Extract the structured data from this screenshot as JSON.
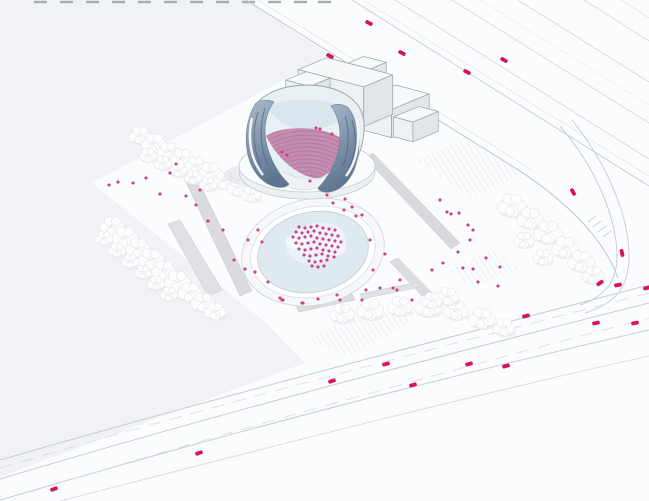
{
  "scene": {
    "width": 649,
    "height": 501
  },
  "palette": {
    "bg": "#fbfcfd",
    "field": "#f1f2f5",
    "accent_pink": "#dd3d86",
    "accent_pink_dark": "#b21e63",
    "car": "#d6135e",
    "road_line": "#c9cdd3",
    "road_line_faint": "#dfe2e6",
    "dash_line": "#d8dbdf",
    "hatch_line": "#e3e5e9",
    "glass_light": "#e9f0f4",
    "glass_mid": "#d9e6ee",
    "seating_pink": "#c58cb1",
    "seat_stripe": "#aa6f9f",
    "wing_top": "#a9bac9",
    "wing_bottom": "#5e7590",
    "wing_streak": "#51688a",
    "box_top": "#f7f8fa",
    "box_front": "#eef0f3",
    "box_side": "#e2e5ea",
    "box_stroke": "#9aa1ab",
    "tree_fill": "#fdfdfe",
    "tree_stroke": "#dcdee4",
    "tree_shadow": "#e9eaee",
    "ramp_fill": "#dadbdf",
    "plaza_floor": "#dfe9f0"
  },
  "ground": {
    "field_polygon": [
      [
        0,
        0
      ],
      [
        246,
        0
      ],
      [
        330,
        55
      ],
      [
        92,
        183
      ],
      [
        265,
        322
      ],
      [
        305,
        363
      ],
      [
        150,
        421
      ],
      [
        0,
        477
      ]
    ],
    "hatches": [
      [
        [
          415,
          160
        ],
        [
          463,
          140
        ],
        [
          524,
          172
        ],
        [
          474,
          199
        ]
      ],
      [
        [
          306,
          341
        ],
        [
          362,
          309
        ],
        [
          420,
          318
        ],
        [
          350,
          356
        ]
      ],
      [
        [
          448,
          268
        ],
        [
          492,
          250
        ],
        [
          520,
          268
        ],
        [
          474,
          288
        ]
      ]
    ],
    "top_dashes": {
      "y": 2,
      "len": 13,
      "xs": [
        34,
        60,
        86,
        112,
        138,
        164,
        190,
        216,
        242,
        268,
        294,
        318
      ]
    }
  },
  "roads": {
    "highway": [
      {
        "d": "M 246,0 L 520,171 C 574,207 605,242 618,278",
        "w": 1.1,
        "c": "#c6cad0"
      },
      {
        "d": "M 258,0 L 532,170",
        "w": 0.7,
        "c": "#dfe2e6"
      },
      {
        "d": "M 352,0 L 649,186",
        "w": 1.0,
        "c": "#ccd0d6"
      },
      {
        "d": "M 363,0 L 649,176",
        "w": 0.6,
        "c": "#e0e3e7"
      },
      {
        "d": "M 395,0 L 649,159",
        "w": 0.8,
        "c": "#d3d6db"
      },
      {
        "d": "M 452,0 L 649,123",
        "w": 0.8,
        "c": "#d3d6db"
      },
      {
        "d": "M 480,0 L 649,105",
        "w": 0.5,
        "c": "#e2e4e8"
      },
      {
        "d": "M 518,0 L 649,82",
        "w": 0.8,
        "c": "#d3d6db"
      },
      {
        "d": "M 584,0 L 649,41",
        "w": 0.8,
        "c": "#d3d6db"
      },
      {
        "d": "M 621,0 L 649,18",
        "w": 0.6,
        "c": "#d8dbdf"
      }
    ],
    "right_road": [
      {
        "d": "M 560,126 C 596,168 615,215 617,252 C 618,281 606,296 580,305",
        "w": 1.0,
        "c": "#c9cdd3"
      },
      {
        "d": "M 572,120 C 608,165 628,215 629,253 C 630,287 615,304 585,313",
        "w": 1.0,
        "c": "#ccd0d6"
      }
    ],
    "boulevard": [
      {
        "d": "M 0,460 C 200,402 420,345 649,285",
        "w": 1.0,
        "c": "#c7cbd1"
      },
      {
        "d": "M 0,479 C 200,419 420,361 649,303",
        "w": 1.0,
        "c": "#c9cdd3"
      },
      {
        "d": "M 0,500 C 210,438 430,380 649,330",
        "w": 1.0,
        "c": "#c9cdd3"
      },
      {
        "d": "M 60,501 C 250,452 460,398 649,356",
        "w": 0.8,
        "c": "#d3d6db"
      }
    ],
    "lane_dashes": [
      {
        "d": "M 0,468 C 200,409 420,352 649,293",
        "w": 0.8,
        "c": "#d8dbdf",
        "dash": "13,9"
      },
      {
        "d": "M 30,492 C 230,431 440,373 649,318",
        "w": 0.8,
        "c": "#d8dbdf",
        "dash": "13,9"
      }
    ],
    "crosswalk_ticks": [
      [
        588,
        222,
        596,
        216
      ],
      [
        593,
        227,
        601,
        221
      ],
      [
        598,
        232,
        606,
        226
      ],
      [
        603,
        237,
        611,
        231
      ]
    ]
  },
  "ramps": [
    {
      "pts": [
        [
          185,
          180
        ],
        [
          196,
          176
        ],
        [
          252,
          291
        ],
        [
          240,
          296
        ]
      ],
      "fill": "#dadbdf"
    },
    {
      "pts": [
        [
          168,
          224
        ],
        [
          180,
          220
        ],
        [
          222,
          290
        ],
        [
          208,
          296
        ]
      ],
      "fill": "#e0e1e4"
    },
    {
      "pts": [
        [
          365,
          158
        ],
        [
          373,
          153
        ],
        [
          460,
          243
        ],
        [
          451,
          249
        ]
      ],
      "fill": "#d8d9dd"
    },
    {
      "pts": [
        [
          390,
          262
        ],
        [
          398,
          258
        ],
        [
          432,
          293
        ],
        [
          424,
          298
        ]
      ],
      "fill": "#dcdde1"
    },
    {
      "pts": [
        [
          296,
          306
        ],
        [
          352,
          294
        ],
        [
          355,
          300
        ],
        [
          299,
          312
        ]
      ],
      "fill": "#dcdde1"
    },
    {
      "pts": [
        [
          360,
          294
        ],
        [
          418,
          282
        ],
        [
          420,
          287
        ],
        [
          362,
          299
        ]
      ],
      "fill": "#e0e1e5"
    }
  ],
  "plaza": {
    "center": [
      313,
      252
    ],
    "rotate": -12,
    "rings": [
      {
        "rx": 72,
        "ry": 53,
        "fill": "#f5f7f9",
        "stroke": "#d0d4da"
      },
      {
        "rx": 63,
        "ry": 45,
        "fill": "#ffffff",
        "stroke": "#dadde2"
      },
      {
        "rx": 56,
        "ry": 40,
        "fill": "#dfe9f0",
        "stroke": "#c2ced7"
      }
    ],
    "floor_blobs": [
      {
        "cx": 318,
        "cy": 244,
        "rx": 30,
        "ry": 20,
        "fill": "#ecf3f7"
      },
      {
        "cx": 300,
        "cy": 238,
        "rx": 12,
        "ry": 8,
        "fill": "#f4f8fa"
      },
      {
        "cx": 333,
        "cy": 252,
        "rx": 14,
        "ry": 9,
        "fill": "#f1f6f9"
      }
    ],
    "ramp_d": "M 252,262 C 258,286 280,300 312,303 C 290,307 266,301 254,288 C 246,277 247,268 252,262 Z"
  },
  "fly_tower": {
    "origin": [
      330,
      96
    ],
    "e1": [
      16,
      4.2
    ],
    "e2": [
      -14.5,
      6
    ],
    "unit_h": 12,
    "boxes": [
      {
        "name": "back-arm",
        "u0": 1.3,
        "v0": -0.9,
        "u1": 2.7,
        "v1": 0.2,
        "h": 3.3
      },
      {
        "name": "right-hall",
        "u0": 4.1,
        "v0": 0.0,
        "u1": 6.2,
        "v1": 2.6,
        "h": 2.35
      },
      {
        "name": "far-annex",
        "u0": 6.2,
        "v0": 0.7,
        "u1": 7.4,
        "v1": 2.45,
        "h": 1.65
      },
      {
        "name": "center-bar",
        "u0": 0.0,
        "v0": 0.2,
        "u1": 4.1,
        "v1": 2.2,
        "h": 3.3
      },
      {
        "name": "left-wing",
        "u0": 0.5,
        "v0": 2.2,
        "u1": 2.0,
        "v1": 3.6,
        "h": 3.3
      }
    ]
  },
  "concert_hall": {
    "shadow": {
      "cx": 268,
      "cy": 175,
      "rx": 44,
      "ry": 13
    },
    "plinth": [
      {
        "cx": 307,
        "cy": 172,
        "rx": 68,
        "ry": 27,
        "fill": "#edf0f3",
        "stroke": "#c6cad0"
      },
      {
        "cx": 307,
        "cy": 166,
        "rx": 68,
        "ry": 26,
        "fill": "#fafbfc",
        "stroke": "#c6cad0"
      }
    ],
    "bowl_d": "M 250,120 C 252,100 272,86 306,85 C 340,85 362,100 364,122 C 365,140 360,158 348,172 C 330,190 288,192 268,176 C 254,164 248,142 250,120 Z",
    "glass_top_d": "M 268,108 C 282,96 334,96 350,112 C 338,124 324,130 306,131 C 288,129 276,120 268,108 Z",
    "seating_d": "M 266,136 C 284,124 330,126 346,142 C 344,158 334,172 318,179 C 298,176 278,160 266,136 Z",
    "stage_d": "M 268,162 C 286,180 324,184 340,170 C 336,182 320,190 300,190 C 284,188 272,176 268,162 Z",
    "left_wing_d": "M 256,103 C 246,118 243,142 250,162 C 255,175 264,184 276,187 C 282,188 287,187 289,184 C 276,172 266,152 265,132 C 265,120 268,110 274,102 C 268,99 260,100 256,103 Z",
    "right_wing_d": "M 350,110 C 360,126 362,150 354,170 C 349,182 340,190 330,192 C 324,193 319,191 318,188 C 330,176 340,156 340,136 C 340,124 337,114 331,106 C 338,103 346,104 350,110 Z",
    "streaks": [
      "M 258,112 C 252,130 253,150 261,166",
      "M 265,108 C 259,128 260,148 268,165",
      "M 352,120 C 357,136 356,154 349,168",
      "M 345,116 C 350,132 349,152 342,167"
    ],
    "ribbons": [
      "M 252,118 C 247,140 251,160 263,175",
      "M 356,118 C 361,140 357,162 346,176"
    ],
    "stripes": {
      "cx": 306,
      "cy": 215,
      "r0": 36,
      "r1": 92,
      "step": 4
    }
  },
  "trees": [
    [
      140,
      135,
      10
    ],
    [
      154,
      143,
      11
    ],
    [
      168,
      151,
      10
    ],
    [
      182,
      158,
      11
    ],
    [
      196,
      165,
      10
    ],
    [
      210,
      172,
      11
    ],
    [
      224,
      180,
      10
    ],
    [
      238,
      187,
      10
    ],
    [
      251,
      194,
      9
    ],
    [
      148,
      155,
      8
    ],
    [
      163,
      163,
      8
    ],
    [
      178,
      170,
      8
    ],
    [
      193,
      177,
      8
    ],
    [
      208,
      184,
      8
    ],
    [
      112,
      226,
      11
    ],
    [
      125,
      237,
      12
    ],
    [
      138,
      248,
      11
    ],
    [
      151,
      259,
      12
    ],
    [
      164,
      270,
      11
    ],
    [
      177,
      281,
      12
    ],
    [
      190,
      292,
      11
    ],
    [
      203,
      302,
      11
    ],
    [
      215,
      311,
      10
    ],
    [
      104,
      238,
      8
    ],
    [
      117,
      250,
      8
    ],
    [
      130,
      261,
      8
    ],
    [
      143,
      272,
      8
    ],
    [
      156,
      283,
      8
    ],
    [
      169,
      294,
      8
    ],
    [
      342,
      313,
      11
    ],
    [
      370,
      309,
      12
    ],
    [
      400,
      306,
      11
    ],
    [
      428,
      306,
      12
    ],
    [
      456,
      310,
      11
    ],
    [
      482,
      318,
      12
    ],
    [
      504,
      327,
      10
    ],
    [
      512,
      205,
      13
    ],
    [
      530,
      218,
      12
    ],
    [
      548,
      232,
      13
    ],
    [
      565,
      247,
      12
    ],
    [
      581,
      261,
      12
    ],
    [
      593,
      275,
      10
    ],
    [
      524,
      240,
      9
    ],
    [
      543,
      257,
      9
    ],
    [
      448,
      296,
      10
    ],
    [
      432,
      300,
      9
    ]
  ],
  "cars": [
    [
      369,
      23,
      27
    ],
    [
      330,
      56,
      27
    ],
    [
      402,
      53,
      27
    ],
    [
      467,
      72,
      27
    ],
    [
      504,
      60,
      27
    ],
    [
      573,
      192,
      62
    ],
    [
      622,
      253,
      78
    ],
    [
      600,
      283,
      -35
    ],
    [
      647,
      288,
      -12
    ],
    [
      618,
      285,
      -12
    ],
    [
      635,
      323,
      -10
    ],
    [
      596,
      323,
      -12
    ],
    [
      526,
      316,
      -15
    ],
    [
      506,
      366,
      -14
    ],
    [
      469,
      364,
      -15
    ],
    [
      413,
      385,
      -16
    ],
    [
      386,
      364,
      -16
    ],
    [
      332,
      381,
      -18
    ],
    [
      199,
      453,
      -19
    ],
    [
      54,
      489,
      -20
    ]
  ],
  "people": {
    "r": 1.4,
    "groups": {
      "west_lawn": [
        [
          109,
          185
        ],
        [
          118,
          182
        ],
        [
          133,
          183
        ],
        [
          146,
          178
        ],
        [
          160,
          194
        ],
        [
          170,
          173
        ],
        [
          176,
          164
        ],
        [
          200,
          190
        ],
        [
          208,
          221
        ],
        [
          223,
          230
        ],
        [
          234,
          260
        ],
        [
          245,
          269
        ],
        [
          196,
          205
        ],
        [
          186,
          196
        ]
      ],
      "north_terrace": [
        [
          327,
          195
        ],
        [
          333,
          203
        ],
        [
          345,
          199
        ],
        [
          352,
          207
        ],
        [
          362,
          215
        ]
      ],
      "east_walk": [
        [
          440,
          200
        ],
        [
          447,
          212
        ],
        [
          451,
          214
        ],
        [
          459,
          213
        ],
        [
          468,
          225
        ],
        [
          473,
          230
        ],
        [
          470,
          240
        ],
        [
          458,
          252
        ],
        [
          443,
          263
        ],
        [
          432,
          270
        ],
        [
          463,
          268
        ],
        [
          473,
          269
        ],
        [
          500,
          267
        ],
        [
          498,
          286
        ],
        [
          486,
          258
        ],
        [
          478,
          282
        ]
      ],
      "plaza_ring": [
        [
          258,
          230
        ],
        [
          248,
          240
        ],
        [
          262,
          242
        ],
        [
          255,
          272
        ],
        [
          268,
          282
        ],
        [
          283,
          300
        ],
        [
          302,
          303
        ],
        [
          280,
          298
        ],
        [
          373,
          270
        ],
        [
          400,
          280
        ],
        [
          393,
          288
        ],
        [
          356,
          216
        ],
        [
          344,
          210
        ],
        [
          370,
          240
        ],
        [
          385,
          254
        ],
        [
          366,
          290
        ],
        [
          340,
          300
        ],
        [
          318,
          299
        ]
      ],
      "south_walk": [
        [
          282,
          300
        ],
        [
          303,
          303
        ],
        [
          337,
          295
        ],
        [
          380,
          288
        ],
        [
          397,
          290
        ],
        [
          362,
          300
        ],
        [
          412,
          300
        ]
      ],
      "hall_interior": [
        [
          316,
          128
        ],
        [
          320,
          129
        ],
        [
          332,
          134
        ],
        [
          310,
          181
        ],
        [
          282,
          152
        ],
        [
          287,
          155
        ]
      ],
      "crowd": [
        [
          299,
          227
        ],
        [
          305,
          228
        ],
        [
          311,
          227
        ],
        [
          317,
          226
        ],
        [
          323,
          228
        ],
        [
          329,
          229
        ],
        [
          335,
          230
        ],
        [
          296,
          232
        ],
        [
          302,
          233
        ],
        [
          308,
          232
        ],
        [
          314,
          231
        ],
        [
          320,
          233
        ],
        [
          326,
          234
        ],
        [
          332,
          235
        ],
        [
          338,
          236
        ],
        [
          293,
          237
        ],
        [
          299,
          238
        ],
        [
          305,
          237
        ],
        [
          311,
          236
        ],
        [
          317,
          238
        ],
        [
          323,
          239
        ],
        [
          329,
          240
        ],
        [
          335,
          241
        ],
        [
          341,
          242
        ],
        [
          296,
          243
        ],
        [
          302,
          244
        ],
        [
          308,
          243
        ],
        [
          314,
          242
        ],
        [
          320,
          244
        ],
        [
          326,
          245
        ],
        [
          332,
          246
        ],
        [
          338,
          247
        ],
        [
          299,
          249
        ],
        [
          305,
          250
        ],
        [
          311,
          249
        ],
        [
          317,
          248
        ],
        [
          323,
          250
        ],
        [
          329,
          251
        ],
        [
          335,
          252
        ],
        [
          304,
          255
        ],
        [
          310,
          256
        ],
        [
          316,
          255
        ],
        [
          322,
          254
        ],
        [
          328,
          256
        ],
        [
          334,
          257
        ],
        [
          309,
          261
        ],
        [
          315,
          262
        ],
        [
          321,
          261
        ],
        [
          327,
          260
        ],
        [
          312,
          266
        ],
        [
          318,
          267
        ],
        [
          324,
          266
        ]
      ]
    }
  }
}
